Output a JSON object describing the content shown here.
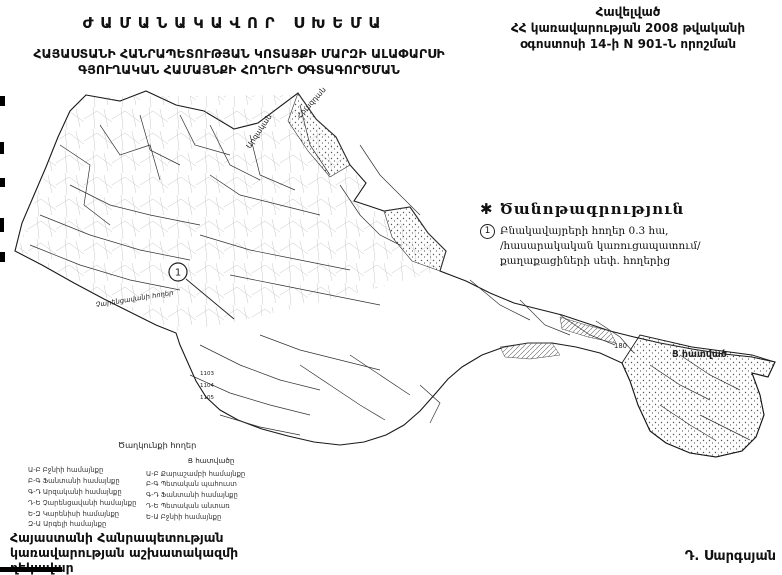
{
  "header": {
    "title": "ԺԱՄԱՆԱԿԱՎՈՐ ՍԽԵՄԱ",
    "subtitle_line1": "ՀԱՅԱՍՏԱՆԻ ՀԱՆՐԱՊԵՏՈՒԹՅԱՆ ԿՈՏԱՅՔԻ ՄԱՐԶԻ ԱԼԱՓԱՐՍԻ",
    "subtitle_line2": "ԳՅՈՒՂԱԿԱՆ ՀԱՄԱՅՆՔԻ ՀՈՂԵՐԻ ՕԳՏԱԳՈՐԾՄԱՆ",
    "appendix_line1": "Հավելված",
    "appendix_line2": "ՀՀ կառավարության 2008 թվականի",
    "appendix_line3": "օգոստոսի 14-ի N 901-Ն որոշման"
  },
  "note": {
    "marker": "✱",
    "title": "Ծանոթագրություն",
    "item_number": "1",
    "line1": "Բնակավայրերի հողեր  0.3  հա,",
    "line2": "/հասարակական կառուցապատում/",
    "line3": "քաղաքացիների սեփ. հողերից"
  },
  "map": {
    "callout_number": "1",
    "parcel_number": "180",
    "parcel_small_1": "1103",
    "parcel_small_2": "1104",
    "parcel_small_3": "1105",
    "section_label_right": "Ց հատված",
    "label_lands_west": "Չարենցավանի հողեր",
    "label_lands_south": "Ծաղկունքի հողեր",
    "border_label_1": "Արզական",
    "border_label_2": "Հրազդան"
  },
  "legend": {
    "left_column": {
      "items": [
        "Ա-Բ Բջնիի համայնքը",
        "Բ-Գ Ֆանտանի համայնքը",
        "Գ-Դ Արզականի համայնքը",
        "Դ-Ե Չարենցավանի համայնքը",
        "Ե-Զ Կարենիսի համայնքը",
        "Զ-Ա Արգելի համայնքը"
      ]
    },
    "right_column": {
      "header": "Ց հատվածը",
      "items": [
        "Ա-Բ Քարաշամբի համայնքը",
        "Բ-Գ Պետական պահուստ",
        "Գ-Դ Ֆանտանի համայնքը",
        "Դ-Ե Պետական անտառ",
        "Ե-Ա Բջնիի համայնքը"
      ]
    }
  },
  "footer": {
    "org_line1": "Հայաստանի Հանրապետության",
    "org_line2": "կառավարության աշխատակազմի",
    "org_line3": "ղեկավար",
    "signature": "Դ. Սարգսյան"
  }
}
